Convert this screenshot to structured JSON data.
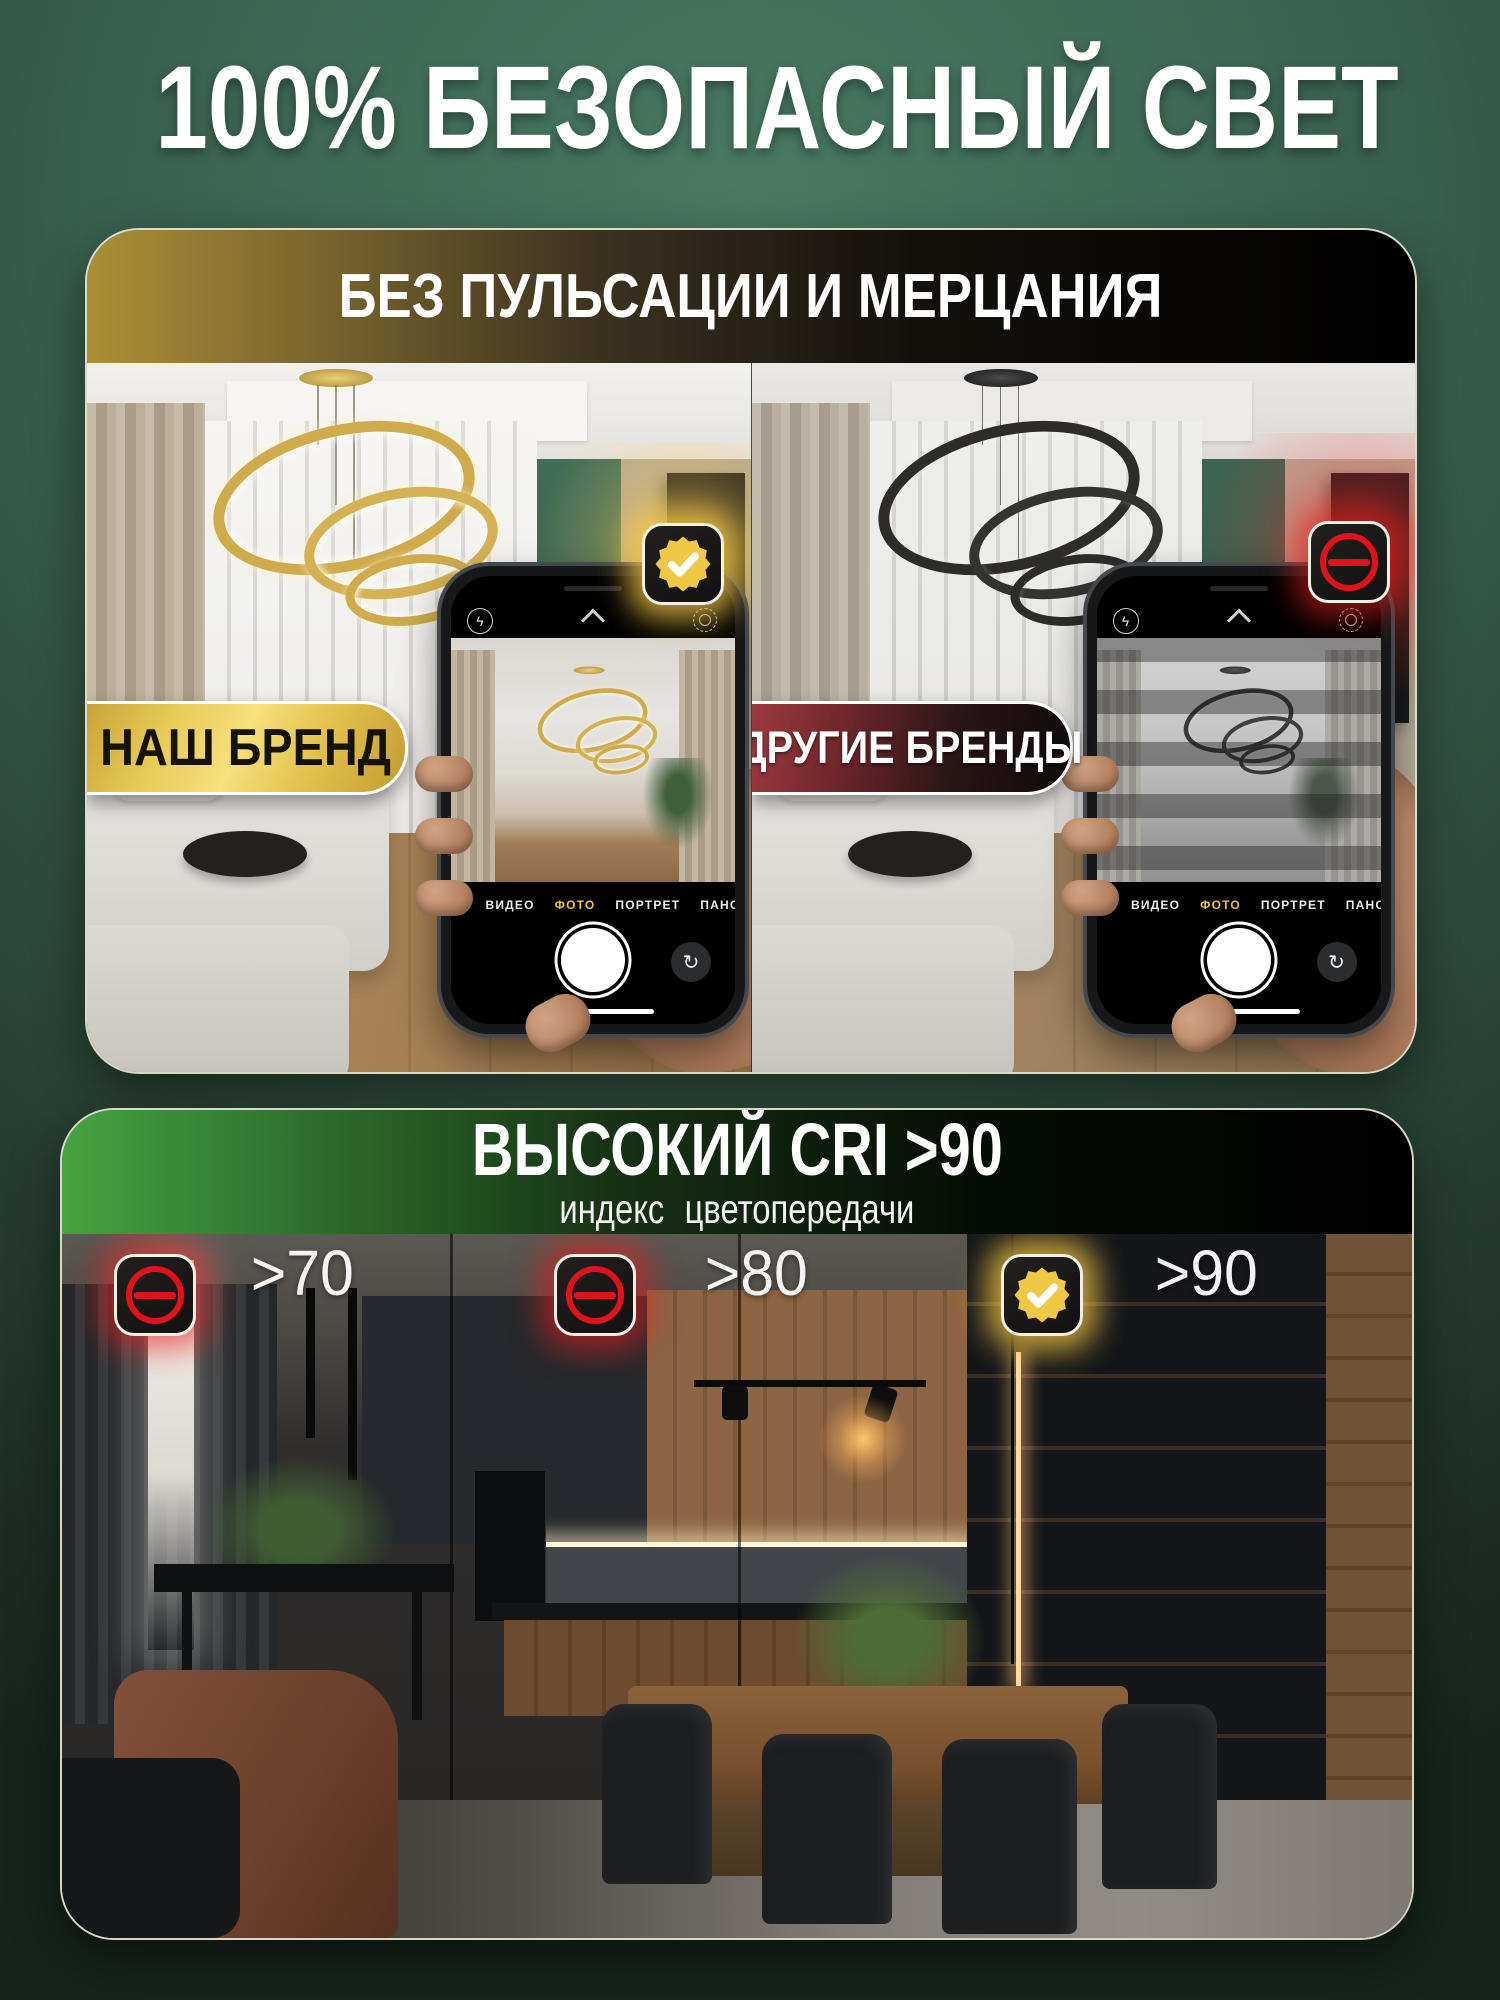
{
  "page": {
    "title": "100% БЕЗОПАСНЫЙ СВЕТ"
  },
  "flicker_card": {
    "header": "БЕЗ ПУЛЬСАЦИИ И МЕРЦАНИЯ",
    "our_brand": {
      "badge_label": "НАШ БРЕНД",
      "status_icon": "gold-check-seal-icon"
    },
    "other_brands": {
      "badge_label": "ДРУГИЕ БРЕНДЫ",
      "status_icon": "red-no-entry-icon"
    },
    "phone_camera": {
      "modes": [
        "ЭФФЕКТ",
        "ВИДЕО",
        "ФОТО",
        "ПОРТРЕТ",
        "ПАНОРАМА"
      ],
      "active_mode": "ФОТО",
      "flash_glyph": "ϟ",
      "flip_glyph": "↻"
    }
  },
  "cri_card": {
    "title": "ВЫСОКИЙ CRI >90",
    "subtitle": "индекс  цветопередачи",
    "zones": [
      {
        "label": ">70",
        "icon": "red-no-entry-icon"
      },
      {
        "label": ">80",
        "icon": "red-no-entry-icon"
      },
      {
        "label": ">90",
        "icon": "gold-check-seal-icon"
      }
    ]
  },
  "colors": {
    "background_green": "#3a614f",
    "accent_gold": "#f0ce5a",
    "accent_red": "#e0121a",
    "accent_green": "#46a441",
    "active_mode_yellow": "#f2c33c"
  }
}
